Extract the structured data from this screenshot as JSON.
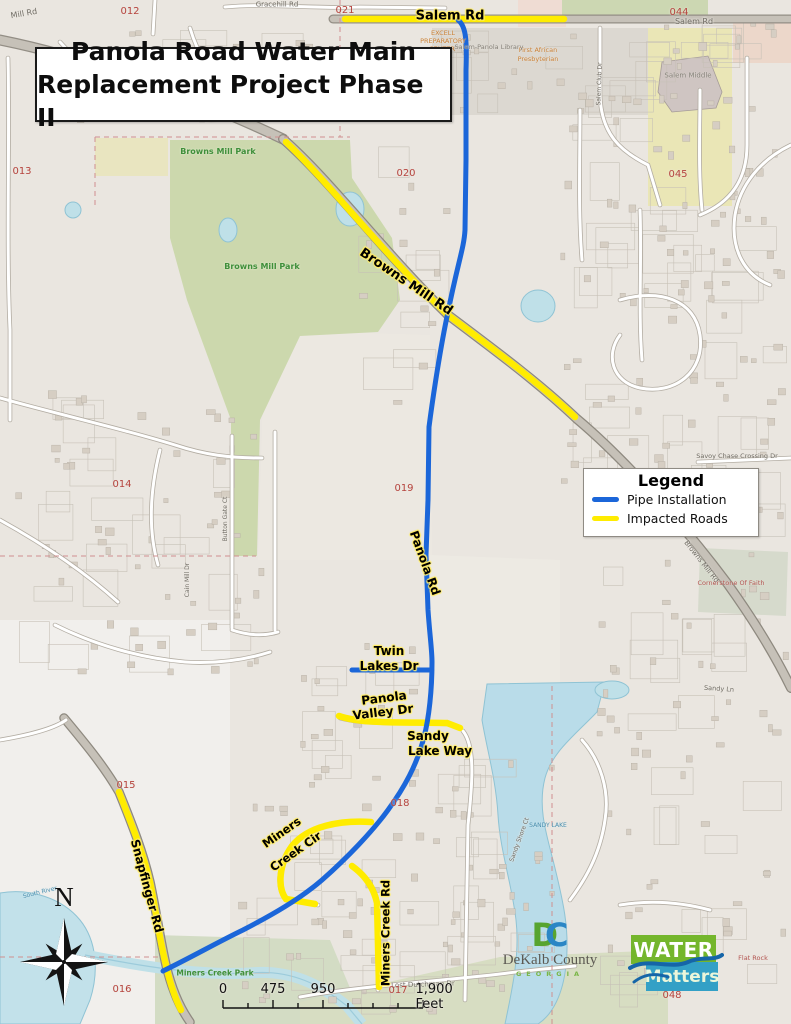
{
  "title": {
    "line1": "Panola Road Water Main",
    "line2": "Replacement Project Phase II"
  },
  "legend": {
    "title": "Legend",
    "items": [
      {
        "label": "Pipe Installation",
        "color": "#1b66d9"
      },
      {
        "label": "Impacted Roads",
        "color": "#ffec00"
      }
    ]
  },
  "scale_bar": {
    "labels": [
      "0",
      "475",
      "950",
      "1,900 Feet"
    ]
  },
  "compass": {
    "label": "N"
  },
  "logos": {
    "dekalb": {
      "monogram_d": "D",
      "monogram_c": "C",
      "name": "DeKalb County",
      "state": "GEORGIA"
    },
    "water_matters": {
      "line1": "WATER",
      "line2": "Matters"
    }
  },
  "colors": {
    "pipe": "#1b66d9",
    "impacted": "#ffec00"
  },
  "map_labels": [
    {
      "t": "Salem Rd",
      "x": 450,
      "y": 16,
      "r": 0,
      "s": 13,
      "k": "hl"
    },
    {
      "t": "Browns Mill Rd",
      "x": 406,
      "y": 282,
      "r": 34,
      "s": 13,
      "k": "hl"
    },
    {
      "t": "Panola Rd",
      "x": 425,
      "y": 563,
      "r": 70,
      "s": 12,
      "k": "hl"
    },
    {
      "t": "Twin",
      "x": 389,
      "y": 651,
      "r": 0,
      "s": 12,
      "k": "hl"
    },
    {
      "t": "Lakes Dr",
      "x": 389,
      "y": 666,
      "r": 0,
      "s": 12,
      "k": "hl"
    },
    {
      "t": "Panola",
      "x": 384,
      "y": 698,
      "r": -7,
      "s": 12,
      "k": "hl"
    },
    {
      "t": "Valley Dr",
      "x": 383,
      "y": 712,
      "r": -7,
      "s": 12,
      "k": "hl"
    },
    {
      "t": "Sandy",
      "x": 428,
      "y": 736,
      "r": 0,
      "s": 12,
      "k": "hl"
    },
    {
      "t": "Lake Way",
      "x": 440,
      "y": 751,
      "r": 0,
      "s": 12,
      "k": "hl"
    },
    {
      "t": "Miners",
      "x": 282,
      "y": 833,
      "r": -35,
      "s": 11.5,
      "k": "hl"
    },
    {
      "t": "Creek Cir",
      "x": 296,
      "y": 852,
      "r": -35,
      "s": 11.5,
      "k": "hl"
    },
    {
      "t": "Miners Creek Rd",
      "x": 386,
      "y": 933,
      "r": -90,
      "s": 11.5,
      "k": "hl"
    },
    {
      "t": "Snapfinger Rd",
      "x": 147,
      "y": 886,
      "r": 75,
      "s": 12,
      "k": "hl"
    },
    {
      "t": "Gracehill Rd",
      "x": 277,
      "y": 5,
      "r": 0,
      "s": 7,
      "k": "mn"
    },
    {
      "t": "Mill Rd",
      "x": 24,
      "y": 14,
      "r": -10,
      "s": 8,
      "k": "mn"
    },
    {
      "t": "Salem Rd",
      "x": 694,
      "y": 22,
      "r": 0,
      "s": 8,
      "k": "mn"
    },
    {
      "t": "Savoy Chase Crossing Dr",
      "x": 737,
      "y": 456,
      "r": 0,
      "s": 6.5,
      "k": "mn"
    },
    {
      "t": "Lost Dutchman Dr",
      "x": 423,
      "y": 985,
      "r": -2,
      "s": 7,
      "k": "mn"
    },
    {
      "t": "Sandy Ln",
      "x": 719,
      "y": 689,
      "r": 4,
      "s": 6.5,
      "k": "mn"
    },
    {
      "t": "Browns Mill Rd",
      "x": 701,
      "y": 562,
      "r": 52,
      "s": 7,
      "k": "mn"
    },
    {
      "t": "Cain Mill Dr",
      "x": 188,
      "y": 580,
      "r": -90,
      "s": 6,
      "k": "mn"
    },
    {
      "t": "Button Gate Ct",
      "x": 226,
      "y": 519,
      "r": -90,
      "s": 6,
      "k": "mn"
    },
    {
      "t": "Salem Club Dr",
      "x": 600,
      "y": 84,
      "r": -88,
      "s": 6,
      "k": "mn"
    },
    {
      "t": "Sandy Shore Ct",
      "x": 520,
      "y": 840,
      "r": -70,
      "s": 6,
      "k": "mn"
    },
    {
      "t": "012",
      "x": 130,
      "y": 12,
      "r": 0,
      "s": 10,
      "k": "pc"
    },
    {
      "t": "021",
      "x": 345,
      "y": 11,
      "r": 0,
      "s": 10,
      "k": "pc"
    },
    {
      "t": "044",
      "x": 679,
      "y": 13,
      "r": 0,
      "s": 10,
      "k": "pc"
    },
    {
      "t": "013",
      "x": 22,
      "y": 172,
      "r": 0,
      "s": 10,
      "k": "pc"
    },
    {
      "t": "020",
      "x": 406,
      "y": 174,
      "r": 0,
      "s": 10,
      "k": "pc"
    },
    {
      "t": "045",
      "x": 678,
      "y": 175,
      "r": 0,
      "s": 10,
      "k": "pc"
    },
    {
      "t": "014",
      "x": 122,
      "y": 485,
      "r": 0,
      "s": 10,
      "k": "pc"
    },
    {
      "t": "019",
      "x": 404,
      "y": 489,
      "r": 0,
      "s": 10,
      "k": "pc"
    },
    {
      "t": "015",
      "x": 126,
      "y": 786,
      "r": 0,
      "s": 10,
      "k": "pc"
    },
    {
      "t": "018",
      "x": 400,
      "y": 804,
      "r": 0,
      "s": 10,
      "k": "pc"
    },
    {
      "t": "016",
      "x": 122,
      "y": 990,
      "r": 0,
      "s": 10,
      "k": "pc"
    },
    {
      "t": "017",
      "x": 398,
      "y": 991,
      "r": 0,
      "s": 10,
      "k": "pc"
    },
    {
      "t": "048",
      "x": 672,
      "y": 996,
      "r": 0,
      "s": 10,
      "k": "pc"
    },
    {
      "t": "Browns Mill Park",
      "x": 218,
      "y": 152,
      "r": 0,
      "s": 8,
      "k": "pk"
    },
    {
      "t": "Browns Mill Park",
      "x": 262,
      "y": 267,
      "r": 0,
      "s": 8,
      "k": "pk"
    },
    {
      "t": "Miners Creek Park",
      "x": 215,
      "y": 973,
      "r": 0,
      "s": 7.5,
      "k": "pk"
    },
    {
      "t": "SANDY LAKE",
      "x": 548,
      "y": 826,
      "r": 0,
      "s": 6,
      "k": "wt"
    },
    {
      "t": "South River",
      "x": 40,
      "y": 893,
      "r": -14,
      "s": 6,
      "k": "wt"
    },
    {
      "t": "EXCELL",
      "x": 443,
      "y": 33,
      "r": 0,
      "s": 6.5,
      "k": "or"
    },
    {
      "t": "PREPARATORY",
      "x": 443,
      "y": 41,
      "r": 0,
      "s": 6.5,
      "k": "or"
    },
    {
      "t": "CENTER",
      "x": 442,
      "y": 49,
      "r": 0,
      "s": 6.5,
      "k": "or"
    },
    {
      "t": "First African",
      "x": 538,
      "y": 50,
      "r": 0,
      "s": 6.5,
      "k": "or"
    },
    {
      "t": "Presbyterian",
      "x": 538,
      "y": 59,
      "r": 0,
      "s": 6.5,
      "k": "or"
    },
    {
      "t": "Salem-Panola Library",
      "x": 489,
      "y": 47,
      "r": 0,
      "s": 6.5,
      "k": "pg"
    },
    {
      "t": "Salem Middle",
      "x": 688,
      "y": 76,
      "r": 0,
      "s": 7,
      "k": "pg"
    },
    {
      "t": "Cornerstone Of Faith",
      "x": 731,
      "y": 583,
      "r": 0,
      "s": 6.5,
      "k": "pr"
    },
    {
      "t": "Flat Rock",
      "x": 753,
      "y": 958,
      "r": 0,
      "s": 6.5,
      "k": "pr"
    }
  ]
}
